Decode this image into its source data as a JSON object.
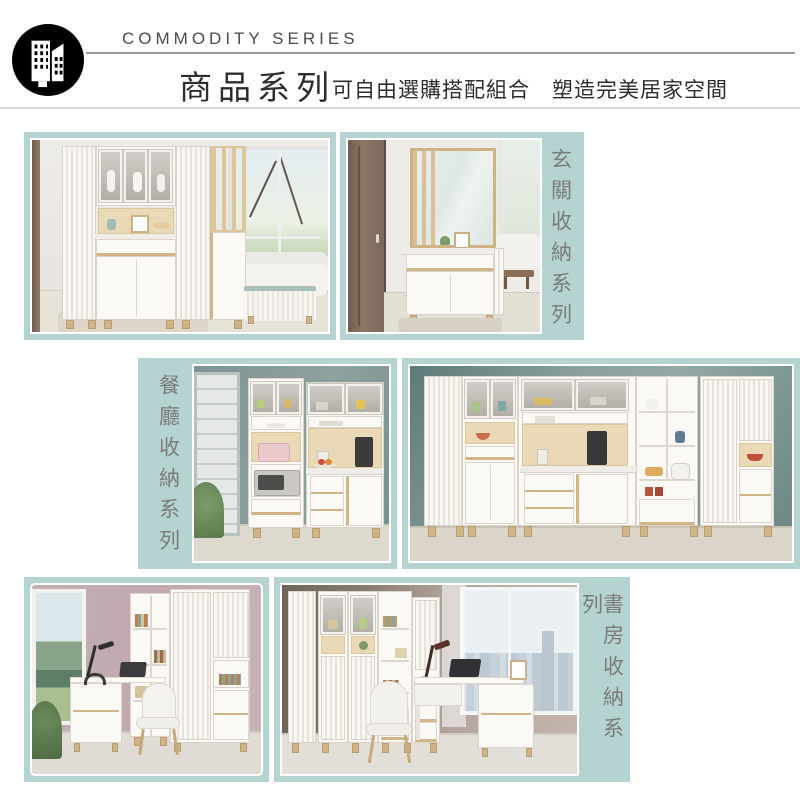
{
  "header": {
    "logo_icon": "buildings-icon",
    "series_en": "COMMODITY SERIES",
    "series_zh": "商品系列",
    "tagline": "可自由選購搭配組合　塑造完美居家空間"
  },
  "colors": {
    "frame": "#b5d4d1",
    "label": "#7b7b7b",
    "rule_dark": "#9b9b9b",
    "rule_light": "#dadada",
    "text_dark": "#2d2d2d",
    "text_en": "#4b4b4b"
  },
  "sections": [
    {
      "label": "玄關收納系列",
      "label_side": "right"
    },
    {
      "label": "餐廳收納系列",
      "label_side": "left"
    },
    {
      "label": "書房收納系列",
      "label_side": "right"
    }
  ]
}
